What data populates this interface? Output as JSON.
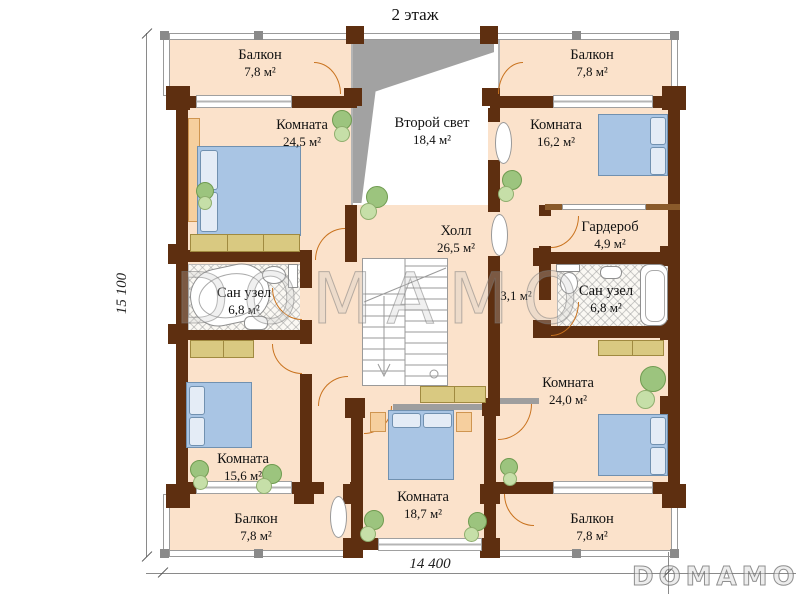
{
  "title": "2 этаж",
  "watermark": "DOMAMO",
  "logo": "DOMAMO",
  "dimensions": {
    "height": "15 100",
    "width": "14 400"
  },
  "rooms": {
    "balcony_tl": {
      "name": "Балкон",
      "area": "7,8 м²"
    },
    "balcony_tr": {
      "name": "Балкон",
      "area": "7,8 м²"
    },
    "room_tl": {
      "name": "Комната",
      "area": "24,5 м²"
    },
    "void": {
      "name": "Второй свет",
      "area": "18,4 м²"
    },
    "room_tr": {
      "name": "Комната",
      "area": "16,2 м²"
    },
    "hall": {
      "name": "Холл",
      "area": "26,5 м²"
    },
    "wardrobe": {
      "name": "Гардероб",
      "area": "4,9 м²"
    },
    "bath_left": {
      "name": "Сан узел",
      "area": "6,8 м²"
    },
    "corridor": {
      "area": "3,1 м²"
    },
    "bath_right": {
      "name": "Сан узел",
      "area": "6,8 м²"
    },
    "room_right": {
      "name": "Комната",
      "area": "24,0 м²"
    },
    "room_bl": {
      "name": "Комната",
      "area": "15,6 м²"
    },
    "room_bc": {
      "name": "Комната",
      "area": "18,7 м²"
    },
    "balcony_bl": {
      "name": "Балкон",
      "area": "7,8 м²"
    },
    "balcony_br": {
      "name": "Балкон",
      "area": "7,8 м²"
    }
  },
  "colors": {
    "wall_brown": "#5e2f10",
    "floor_peach": "#fbe2cb",
    "bed_blue": "#a9c5e4",
    "furniture_tan": "#d9c981",
    "door_orange": "#c9731f",
    "plant_green": "#9cc47e",
    "slope_gray": "#a2a2a2"
  }
}
